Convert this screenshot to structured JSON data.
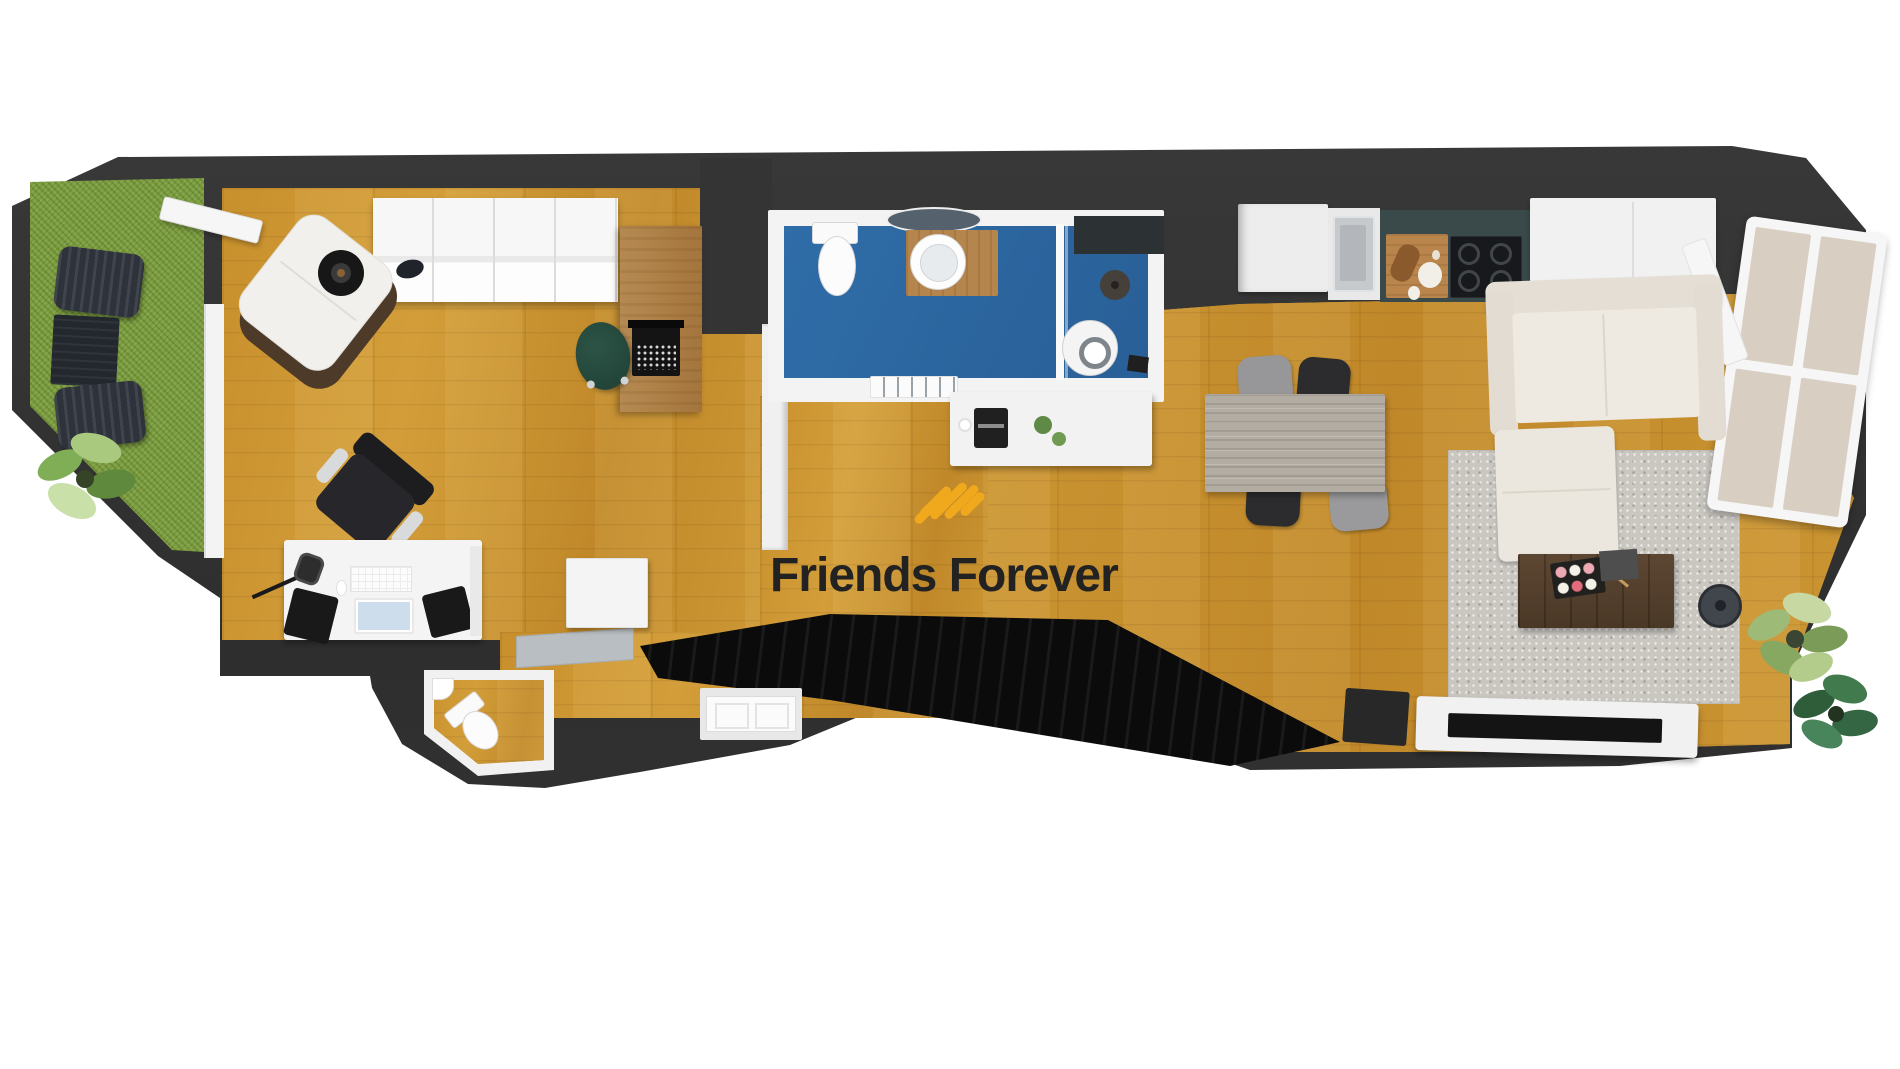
{
  "meta": {
    "kind": "3d-floor-plan-render",
    "view": "top-down",
    "background": "#FFFFFF"
  },
  "watermark": {
    "brand": "Friends Forever",
    "logo": "amber-diagonal-stripes-icon",
    "accent_color": "#F0A91C",
    "text_color": "#222222"
  },
  "palette": {
    "exterior_wall": "#343434",
    "interior_wall": "#F0F0F0",
    "wood_floor": "#C9912F",
    "bathroom_floor": "#2E6BA8",
    "balcony_grass": "#7B9C40",
    "rug": "#CAC7C1",
    "staircase": "#0B0B0B",
    "counter_teal": "#3A4A4B"
  },
  "rooms": [
    {
      "id": "balcony",
      "floor": "grass",
      "items": [
        "sun-lounger",
        "outdoor-side-table",
        "sun-lounger",
        "potted-plant",
        "open-french-door"
      ]
    },
    {
      "id": "bedroom-office",
      "floor": "wood",
      "items": [
        "armchair",
        "round-side-table-with-lamp",
        "open-shelving-wardrobe",
        "wooden-writing-desk",
        "typewriter",
        "green-desk-chair",
        "office-swivel-chair",
        "studio-desk",
        "studio-microphone",
        "keyboard",
        "mouse",
        "speaker",
        "speaker",
        "tablet-screen"
      ]
    },
    {
      "id": "bathroom",
      "floor": "blue-tile",
      "items": [
        "wall-hung-toilet",
        "round-vessel-sink",
        "wood-vanity",
        "round-mirror",
        "glass-shower-partition",
        "shower-floor-drain",
        "dark-wall-panel",
        "towel-radiator"
      ]
    },
    {
      "id": "hallway-entry",
      "floor": "wood",
      "items": [
        "white-storage-cabinet",
        "stair-landing-step",
        "front-door",
        "coffee-bar-island",
        "coffee-machine",
        "coffee-cup",
        "small-plants",
        "round-basin",
        "black-faucet"
      ]
    },
    {
      "id": "guest-wc",
      "floor": "wood",
      "items": [
        "toilet",
        "corner-hand-basin"
      ]
    },
    {
      "id": "staircase",
      "floor": "black-steps",
      "items": [
        "descending-stairs"
      ]
    },
    {
      "id": "kitchen",
      "floor": "wood",
      "items": [
        "tall-fridge-cabinet",
        "stainless-sink",
        "teal-countertop",
        "cutting-board-with-food",
        "induction-cooktop-4-burners",
        "white-upper-cabinet",
        "wood-shelf"
      ]
    },
    {
      "id": "living-dining",
      "floor": "wood",
      "items": [
        "dining-table",
        "gray-chair",
        "black-chair",
        "black-chair",
        "gray-chair",
        "l-shaped-beige-sofa",
        "gray-area-rug",
        "walnut-coffee-table",
        "sushi-platter",
        "chopsticks",
        "gray-box",
        "robot-vacuum",
        "variegated-plant",
        "monstera-plant",
        "speaker-box",
        "white-tv-stand",
        "flat-tv",
        "large-open-window"
      ]
    }
  ]
}
